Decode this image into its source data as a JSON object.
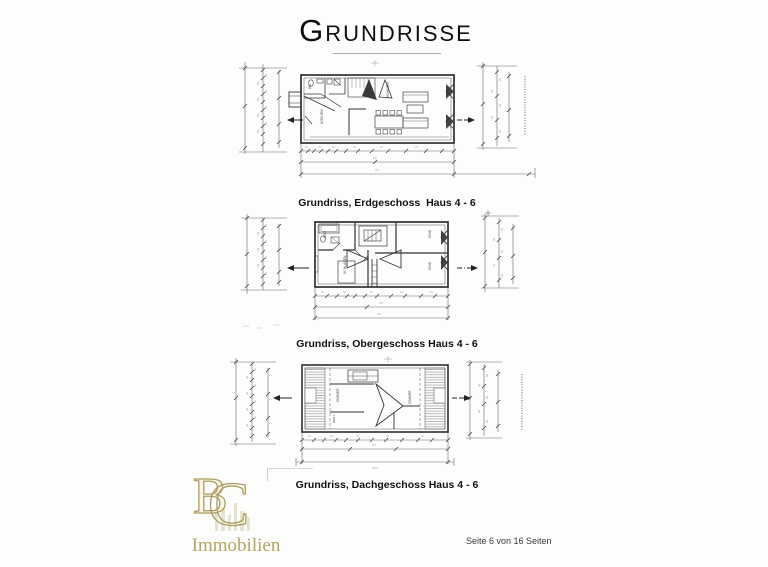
{
  "page": {
    "title_initial": "G",
    "title_rest": "RUNDRISSE",
    "footer": "Seite 6 von 16 Seiten"
  },
  "plans": [
    {
      "caption": "Grundriss, Erdgeschoss  Haus 4 - 6",
      "room_labels": [
        "WC",
        "KOCHEN",
        "WOHNEN"
      ]
    },
    {
      "caption": "Grundriss, Obergeschoss Haus 4 - 6",
      "room_labels": [
        "BAD",
        "SCHLAFEN",
        "KIND",
        "KIND"
      ]
    },
    {
      "caption": "Grundriss, Dachgeschoss Haus 4 - 6",
      "room_labels": [
        "ZIMMER",
        "ABST.",
        "ZIMMER"
      ]
    }
  ],
  "logo": {
    "monogram_left": "B",
    "monogram_right": "C",
    "wordmark": "Immobilien",
    "gold": "#b2a363"
  },
  "colors": {
    "wall_line": "#2f2f2f",
    "thin_line": "#555555",
    "dimension_line": "#666666",
    "background": "#fdfdfc"
  }
}
